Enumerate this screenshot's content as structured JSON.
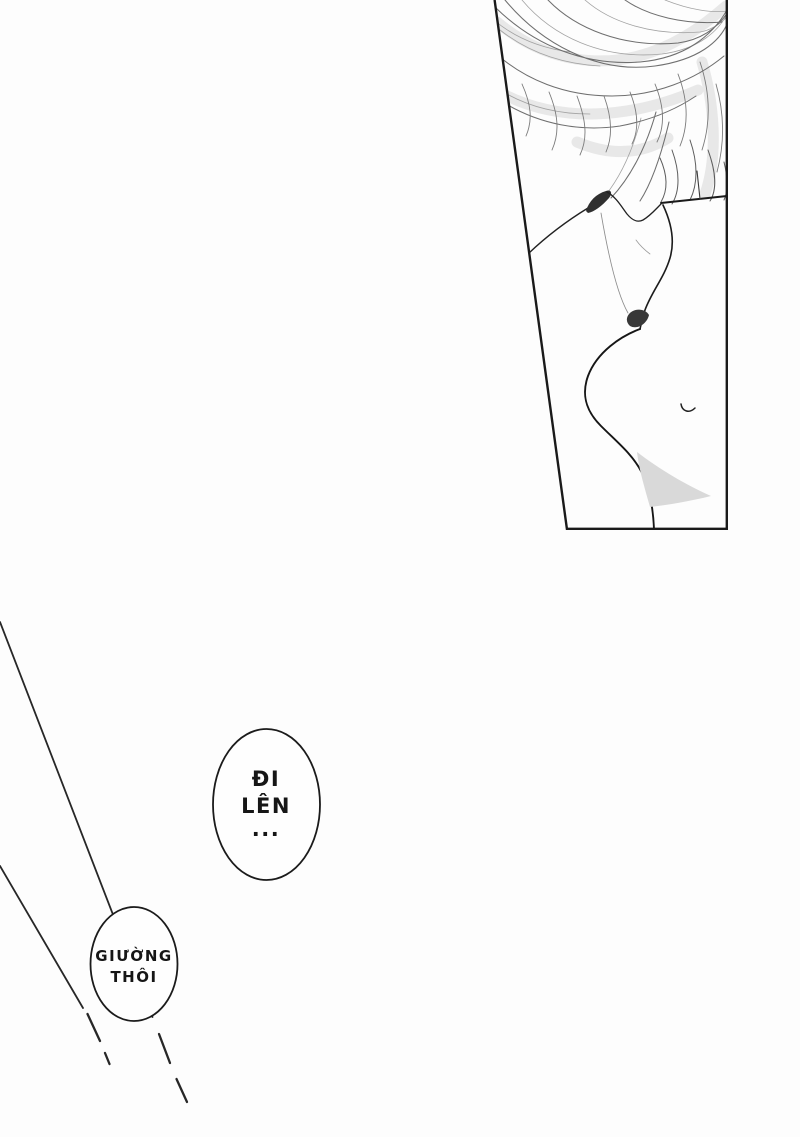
{
  "page": {
    "background": "#fdfdfd",
    "ink": "#1a1a1a",
    "screentone": "#d9d9d9",
    "bubble_fill": "#fefefe",
    "description": "Manga page: top-right trapezoid panel with close-up line art of a character's tousled hair, jaw, bare neck and chest with navel; diagonal motion lines lead to two speech bubbles."
  },
  "speech_bubbles": [
    {
      "id": "bubble-di-len",
      "lines": [
        "ĐI",
        "LÊN",
        "..."
      ]
    },
    {
      "id": "bubble-giuong-thoi",
      "lines": [
        "GIƯỜNG",
        "THÔI"
      ]
    }
  ]
}
